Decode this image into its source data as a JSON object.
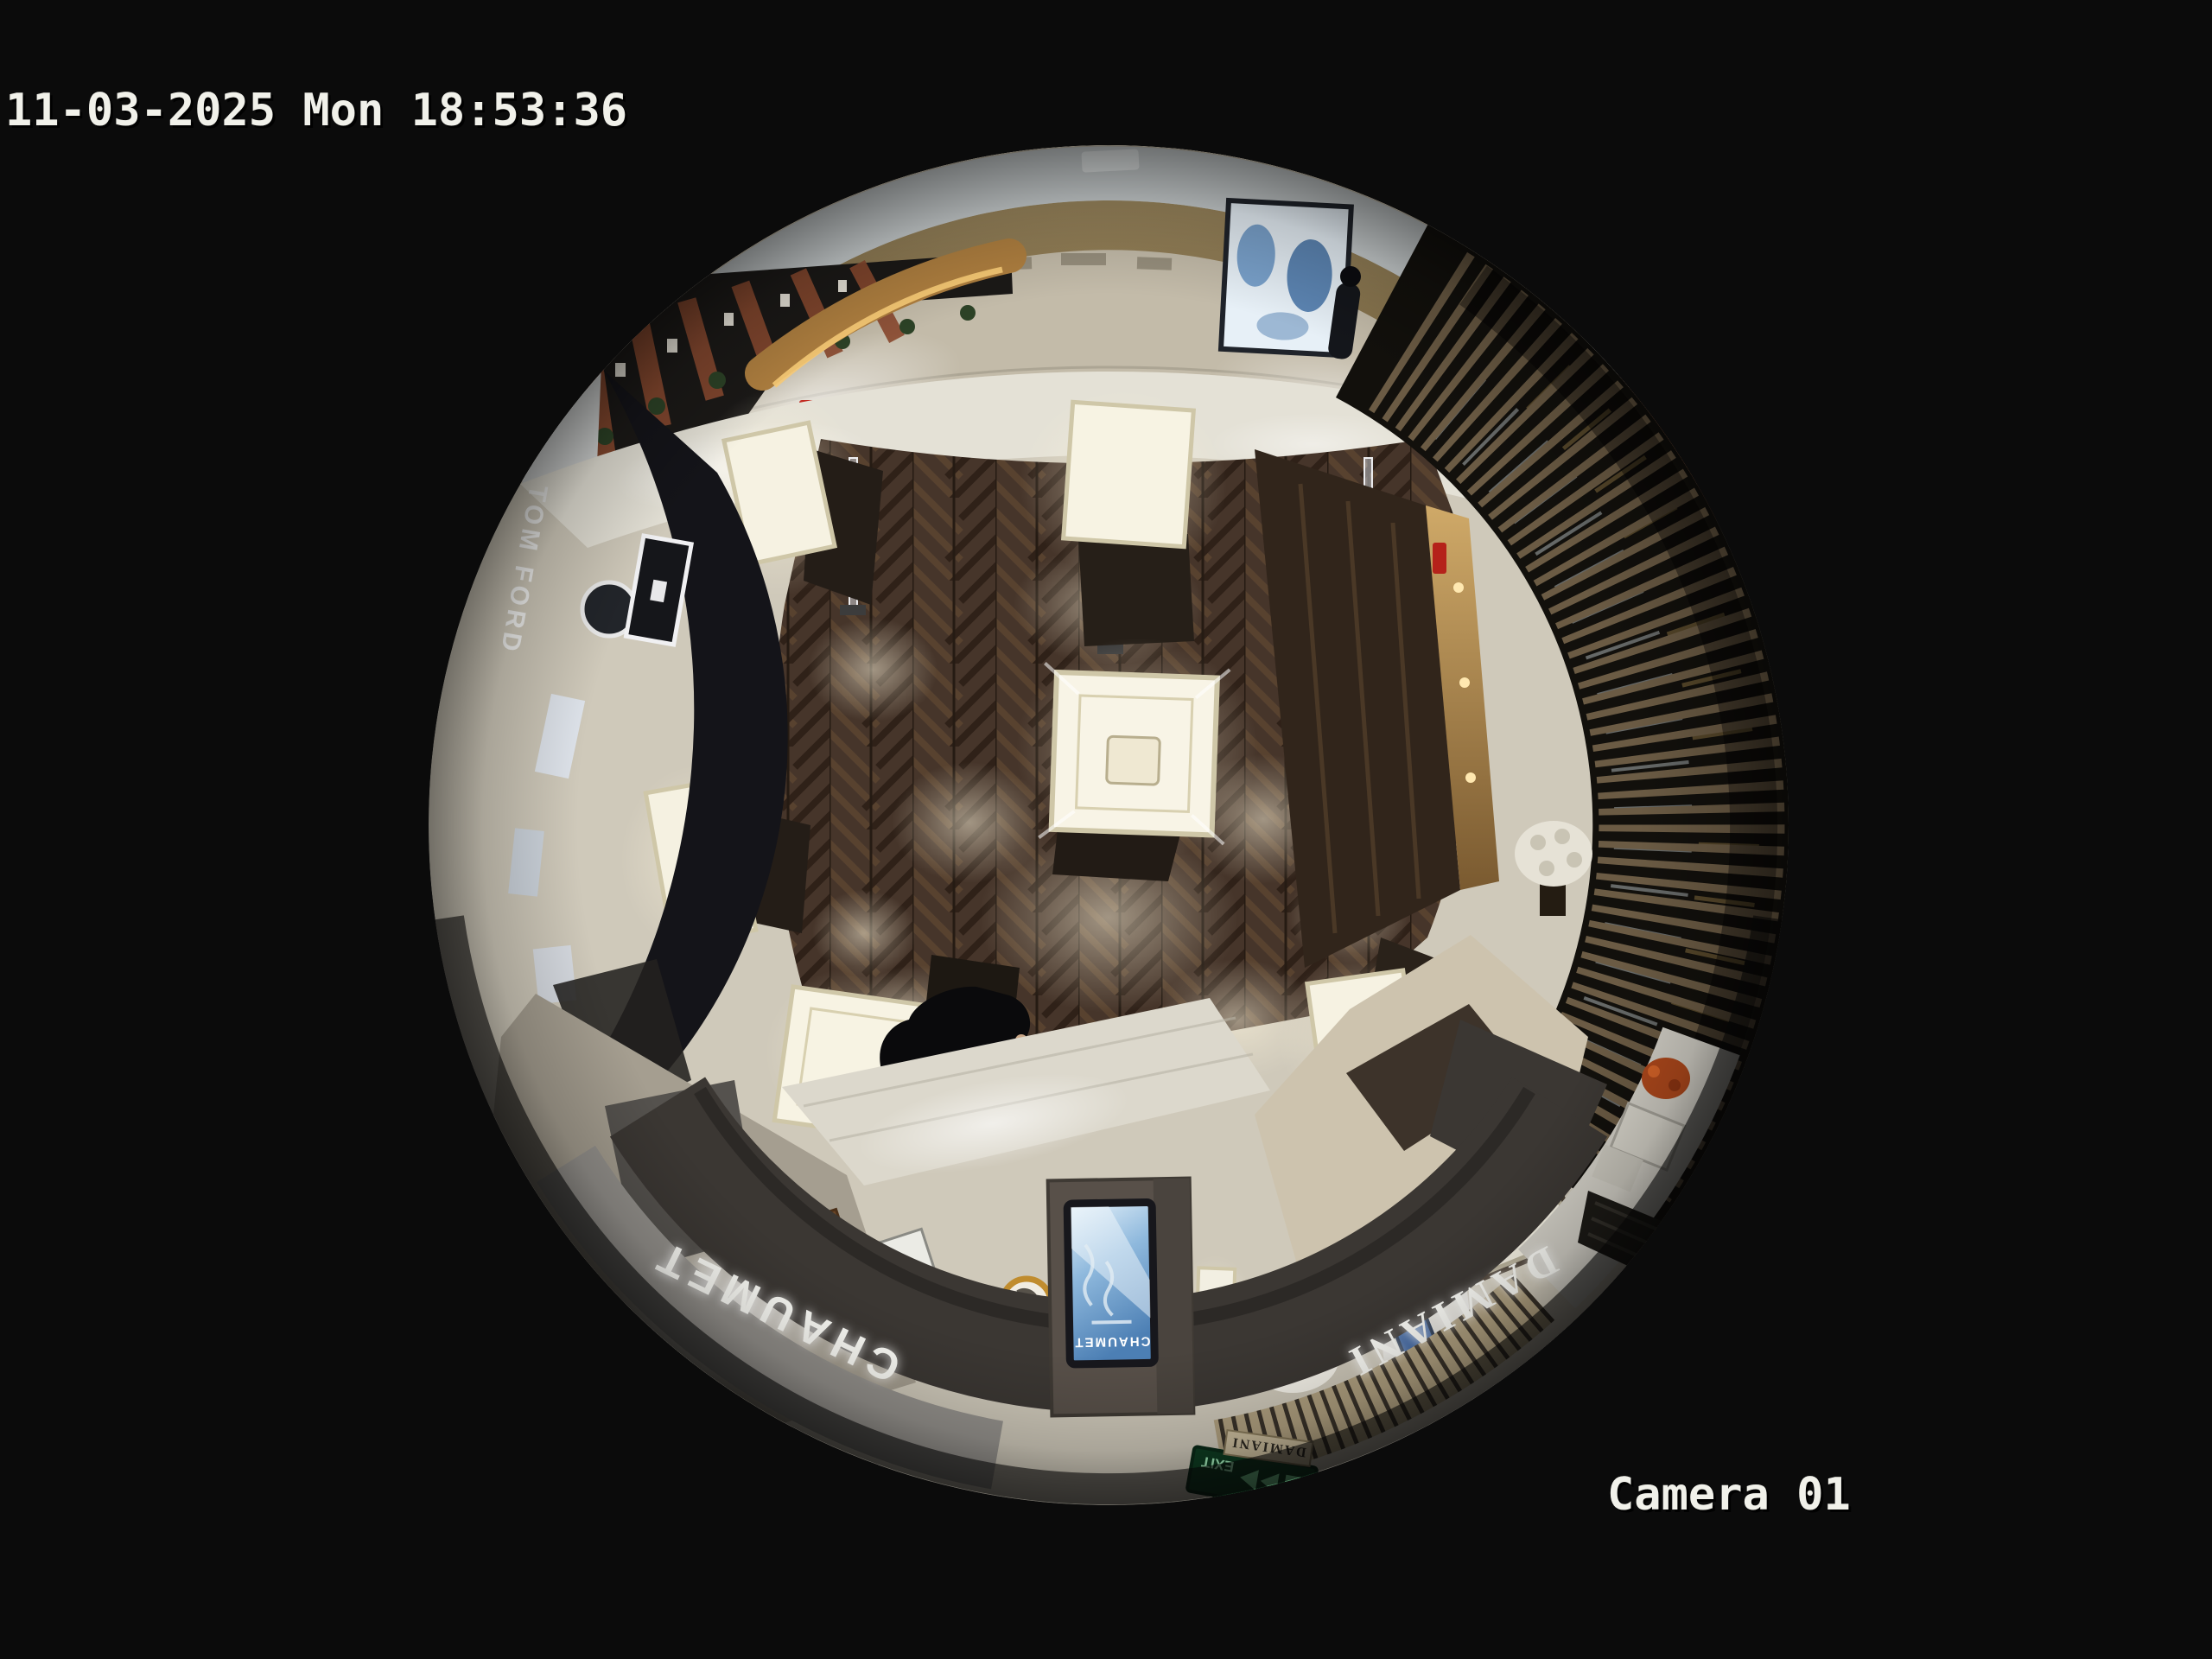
{
  "osd": {
    "timestamp": "11-03-2025 Mon 18:53:36",
    "camera_label": "Camera 01",
    "text_color": "#f1f1ea"
  },
  "signs": {
    "tom_ford": "TOM FORD",
    "chaumet_fascia": "CHAUMET",
    "damiani_fascia": "DAMIANI",
    "kiosk_brand": "CHAUMET",
    "damiani_entrance": "DAMIANI",
    "exit": "EXIT"
  },
  "scene_colors": {
    "background": "#0b0b0b",
    "wood_floor": "#46352a",
    "tile_floor": "#cfc9ba",
    "marble_floor": "#c3bba9",
    "gold_wall": "#8d7a4e",
    "fascia_dark": "#3b3733",
    "kiosk_screen_blue": "#5d93c8",
    "exit_sign_green": "#0e3d22",
    "slat_wall_brown": "#6b5b44",
    "case_glow": "#f7f3e3"
  }
}
